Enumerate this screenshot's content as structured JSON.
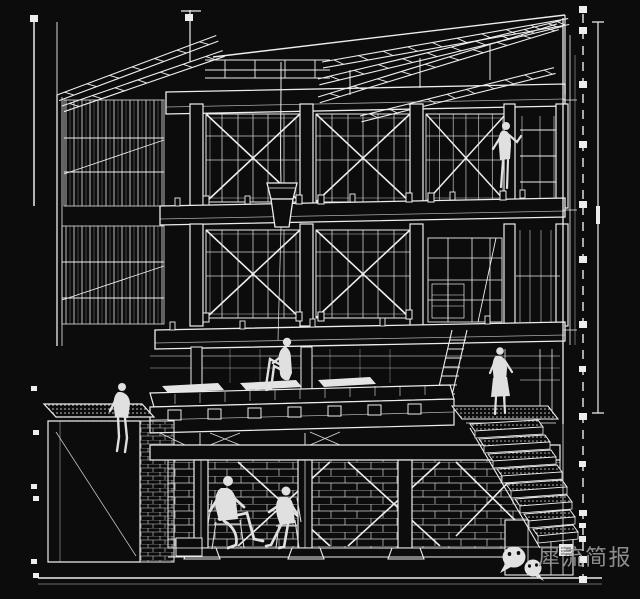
{
  "canvas": {
    "background": "#0c0c0c",
    "line_color": "#ededed",
    "alt": "White line sectional perspective drawing of a multi-storey timber-framed building with six human figures, roof rafters, cross-braced window bays, basement and stair flight"
  },
  "watermark": {
    "label": "犀流简报",
    "text_color": "#9a9a9a",
    "icon": "wechat-icon"
  },
  "guides": {
    "left_marks": "dashed registration line with square beads",
    "right_marks": "dashed registration line with square beads and solid scale bar"
  }
}
